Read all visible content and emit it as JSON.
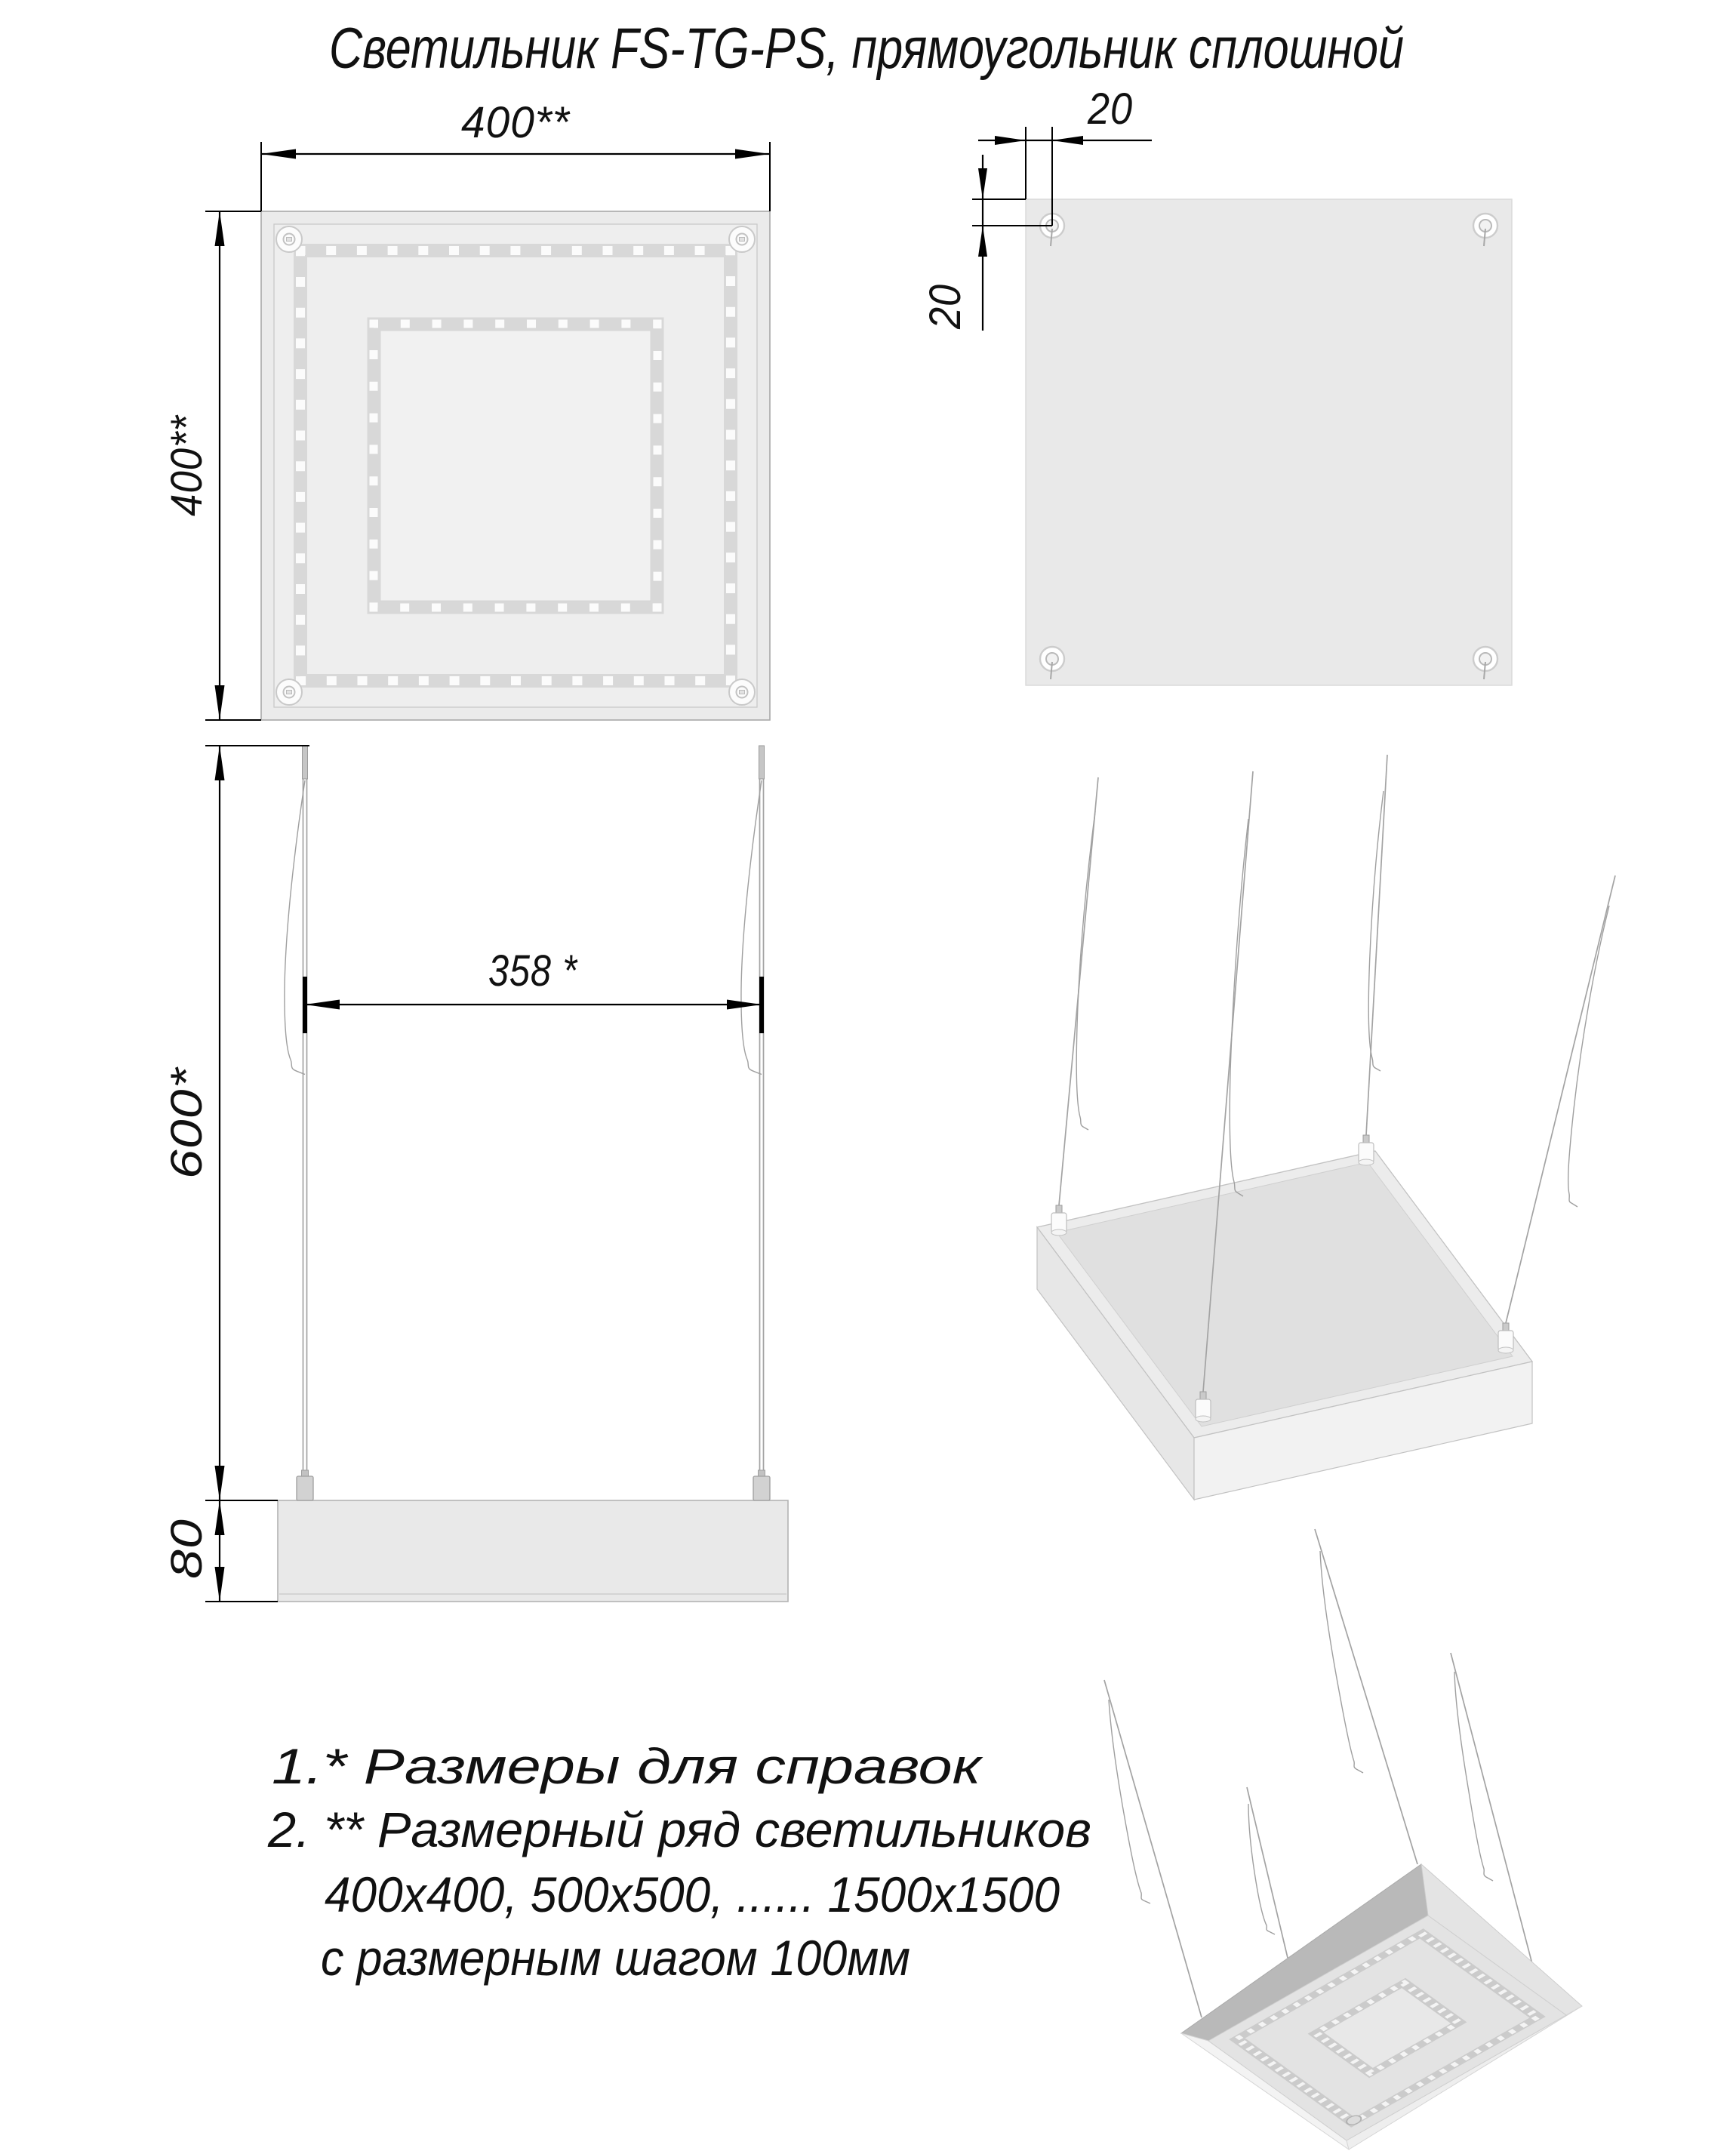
{
  "title": "Светильник FS-TG-PS, прямоугольник сплошной",
  "dims": {
    "panel_width": "400**",
    "panel_height": "400**",
    "hole_offset_x": "20",
    "hole_offset_y": "20",
    "cable_span": "358 *",
    "cable_length": "600*",
    "body_height": "80"
  },
  "notes": {
    "n1": "1.* Размеры для справок",
    "n2": "2. ** Размерный ряд светильников",
    "n3": "400х400, 500х500, ...... 1500х1500",
    "n4": "с размерным шагом 100мм"
  },
  "colors": {
    "line": "#000000",
    "panel_face": "#ebebeb",
    "panel_top": "#e9e9e9",
    "led_band": "#d8d8d8",
    "led_dot": "#fbfbfb",
    "dark_face": "#b9b9b9",
    "wire": "#a3a3a3"
  }
}
